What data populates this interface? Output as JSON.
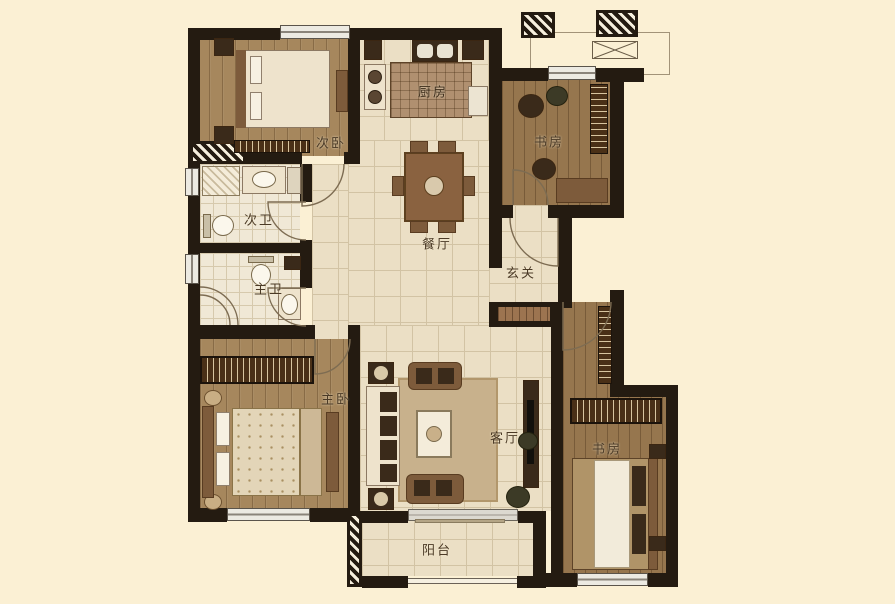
{
  "floorplan": {
    "background_color": "#fbf0d4",
    "wall_color": "#241b11",
    "wood_floor_color": "#a6875d",
    "tile_floor_color": "#ebdfc5",
    "rooms": [
      {
        "id": "bedroom-second",
        "label": "次卧"
      },
      {
        "id": "kitchen",
        "label": "厨房"
      },
      {
        "id": "study-top",
        "label": "书房"
      },
      {
        "id": "bath-second",
        "label": "次卫"
      },
      {
        "id": "bath-master",
        "label": "主卫"
      },
      {
        "id": "dining",
        "label": "餐厅"
      },
      {
        "id": "foyer",
        "label": "玄关"
      },
      {
        "id": "bedroom-master",
        "label": "主卧"
      },
      {
        "id": "living",
        "label": "客厅"
      },
      {
        "id": "study-bottom",
        "label": "书房"
      },
      {
        "id": "balcony",
        "label": "阳台"
      }
    ]
  }
}
